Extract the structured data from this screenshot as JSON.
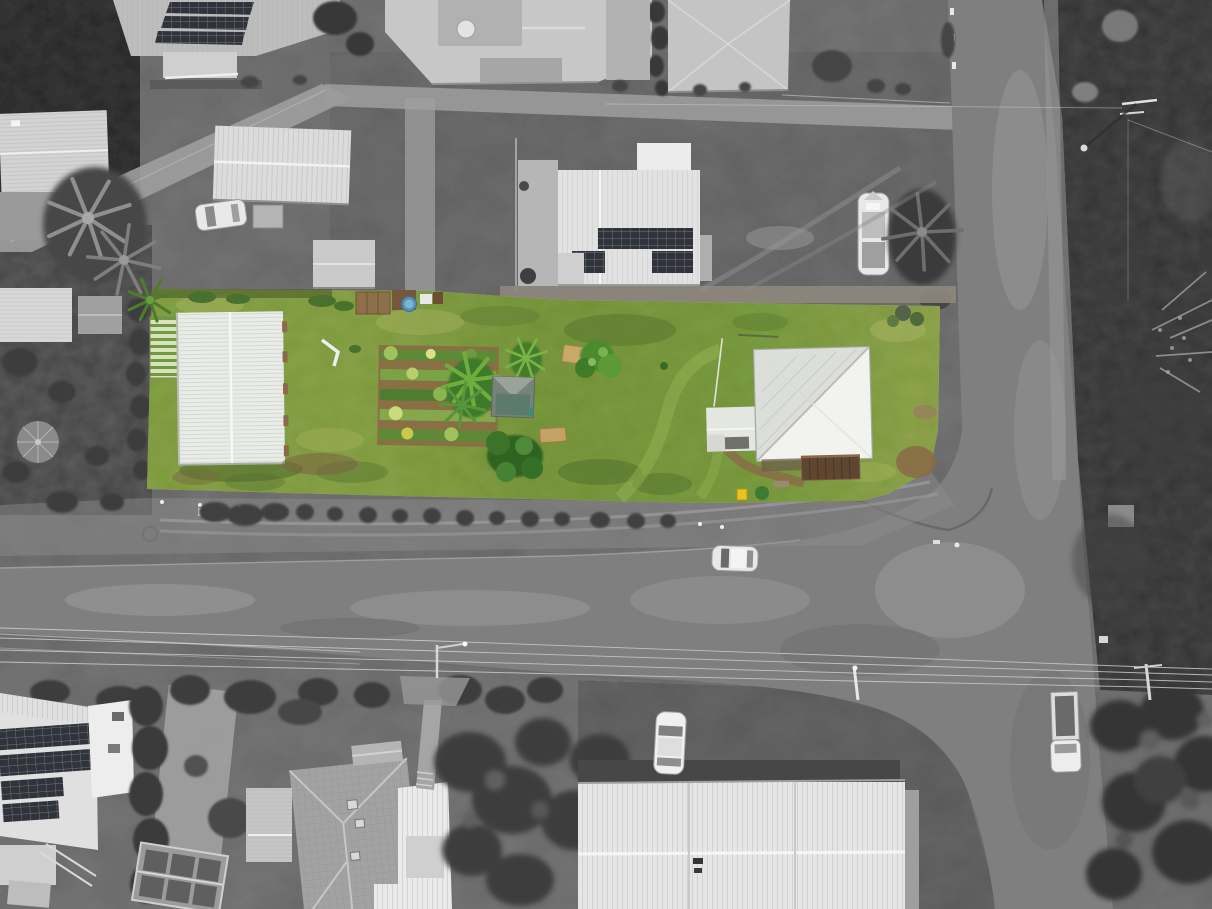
{
  "image": {
    "kind": "aerial-drone-photograph",
    "description": "Top-down aerial photo of a residential block. The subject lot is shown in colour (green lawn, gardens, white shed and white hip-roof house) while all surrounding streets, houses, paddock and trees are desaturated black-and-white.",
    "width_px": 1212,
    "height_px": 909
  },
  "subject_property": {
    "label": "highlighted-lot",
    "features": [
      "large white workshop shed",
      "green slatted shade house",
      "vegetable garden beds in rows",
      "small garden shed",
      "banana palms and shrubs",
      "hay bales",
      "round blue tub pool",
      "white hip-roof house with rear timber deck",
      "yellow wheelie bin",
      "open mown lawn"
    ]
  },
  "surroundings": {
    "label": "grayscale-neighbourhood",
    "features": [
      "houses with rooftop solar panels",
      "long farm sheds",
      "parked caravan",
      "palm trees and hedges",
      "T-intersection of two streets",
      "silver car driving on street",
      "parked white car and white utility vehicle",
      "timber power poles with overhead lines",
      "dark open paddock",
      "street trees along verge",
      "glass greenhouse",
      "large tiled-roof house",
      "gravel driveways"
    ]
  },
  "colors": {
    "grass": "#82a047",
    "grassLight": "#a8b364",
    "grassDark": "#5d7c33",
    "soil": "#8a6a45",
    "treeGreen": "#4c8a2e",
    "roofWhite": "#f2f2ef",
    "roofShade": "#dcdfd9",
    "shedWhite": "#e9ebe7",
    "deckBrown": "#5f4632",
    "binYellow": "#e9c324",
    "poolBlue": "#5590b6",
    "asphalt": "#7f7f7f",
    "ground": "#7d7d7d",
    "vegDark": "#3f3f3f",
    "field": "#4f4f4f",
    "roofLightGray": "#cacaca",
    "solar": "#30343a"
  }
}
